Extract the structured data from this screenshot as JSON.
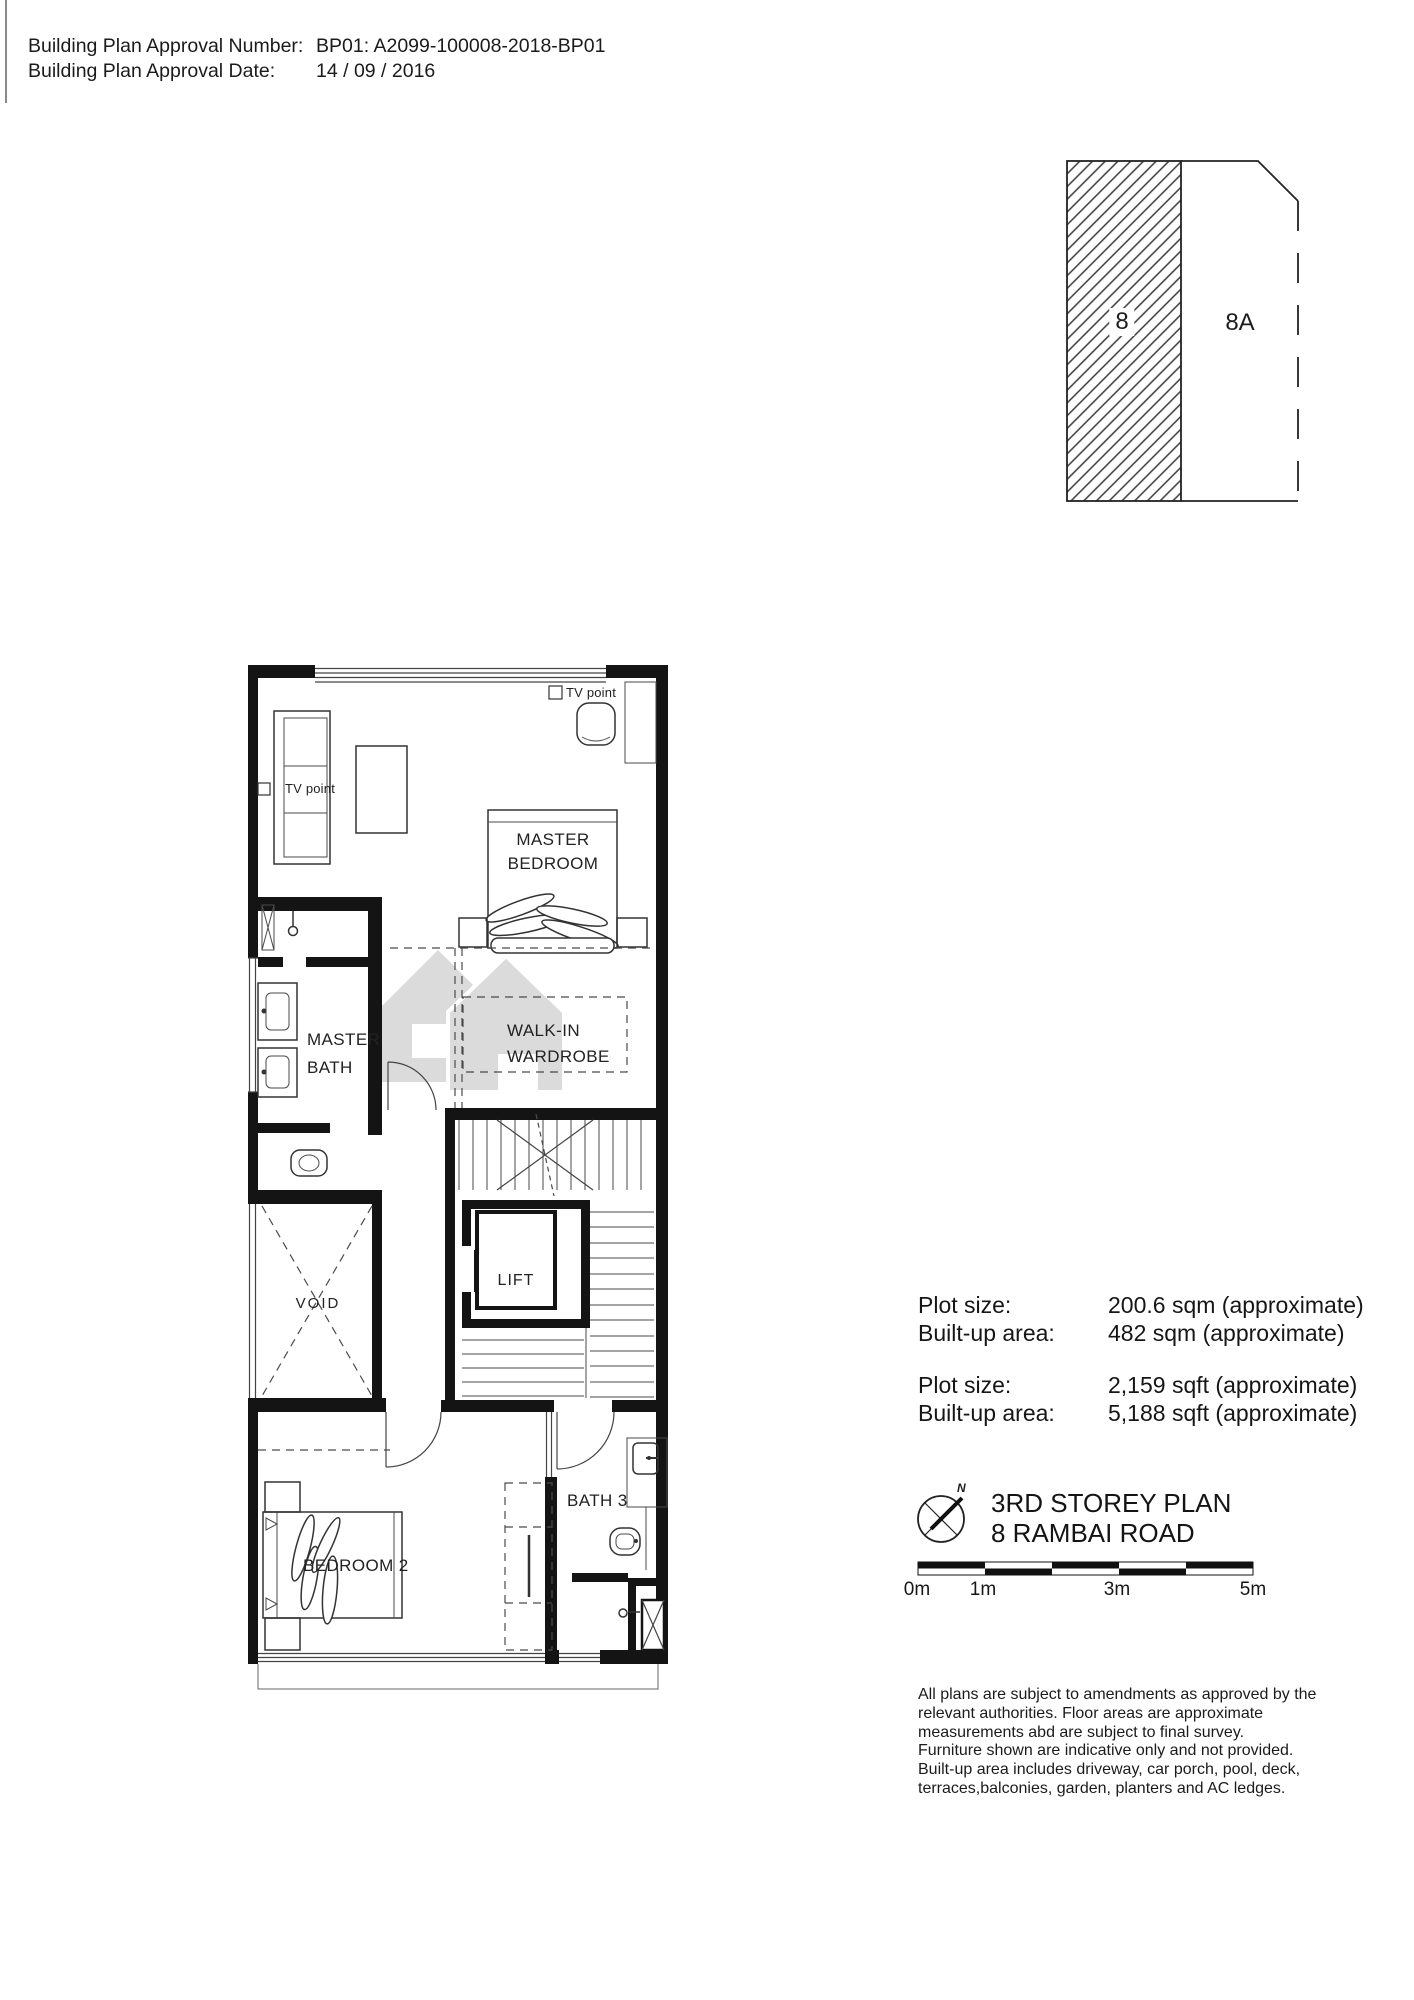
{
  "page_header": {
    "approval_number_label": "Building Plan Approval Number:",
    "approval_number_value": "BP01: A2099-100008-2018-BP01",
    "approval_date_label": "Building Plan Approval Date:",
    "approval_date_value": "14 / 09 / 2016"
  },
  "lot_diagram": {
    "lot_8_label": "8",
    "lot_8a_label": "8A"
  },
  "floor_plan": {
    "labels": {
      "tv_point_top": "TV point",
      "tv_point_side": "TV point",
      "master_bedroom_line1": "MASTER",
      "master_bedroom_line2": "BEDROOM",
      "walk_in_line1": "WALK-IN",
      "walk_in_line2": "WARDROBE",
      "master_bath_line1": "MASTER",
      "master_bath_line2": "BATH",
      "lift": "LIFT",
      "void": "VOID",
      "bedroom_2": "BEDROOM 2",
      "bath_3": "BATH 3"
    },
    "icons": {
      "watermark": "house-watermark",
      "compass": "compass-north-icon"
    }
  },
  "area_info": {
    "rows_metric": [
      {
        "label": "Plot size:",
        "value": "200.6 sqm (approximate)"
      },
      {
        "label": "Built-up area:",
        "value": "482 sqm (approximate)"
      }
    ],
    "rows_imperial": [
      {
        "label": "Plot size:",
        "value": "2,159 sqft (approximate)"
      },
      {
        "label": "Built-up area:",
        "value": "5,188 sqft (approximate)"
      }
    ]
  },
  "title_block": {
    "plan_title": "3RD STOREY PLAN",
    "address": "8 RAMBAI ROAD",
    "north_label": "N"
  },
  "scale_bar": {
    "tick_labels": [
      "0m",
      "1m",
      "3m",
      "5m"
    ]
  },
  "disclaimer": {
    "lines": [
      "All plans are subject to amendments as approved by the",
      "relevant authorities. Floor areas are approximate",
      "measurements abd are subject to final survey.",
      "Furniture shown are indicative only and not provided.",
      "Built-up area includes driveway, car porch, pool, deck,",
      "terraces,balconies, garden, planters and AC ledges."
    ]
  }
}
